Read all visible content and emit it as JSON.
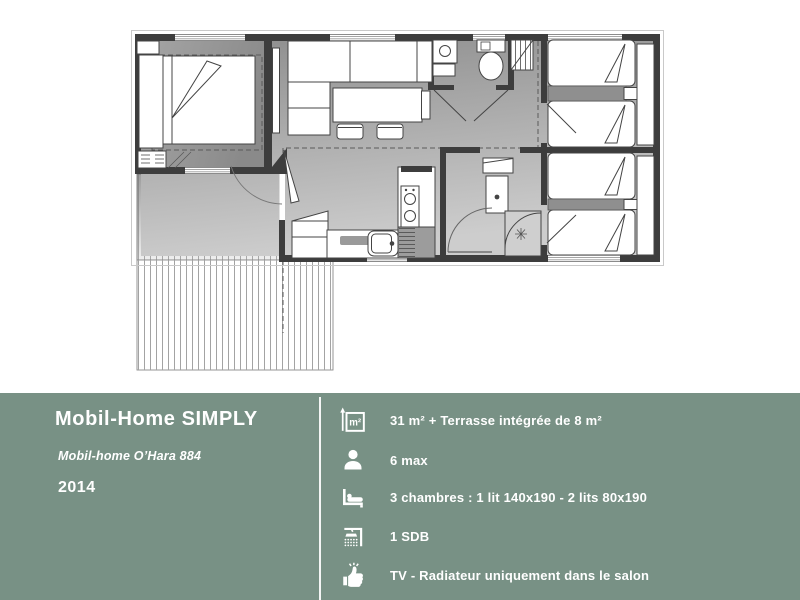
{
  "panel": {
    "background": "#789185",
    "text_color": "#ffffff",
    "title": "Mobil-Home SIMPLY",
    "subtitle": "Mobil-home O’Hara 884",
    "year": "2014",
    "features": [
      {
        "icon": "area-icon",
        "label": "31 m²  + Terrasse intégrée de 8 m²"
      },
      {
        "icon": "person-icon",
        "label": "6 max"
      },
      {
        "icon": "bed-icon",
        "label": "3 chambres : 1 lit 140x190 - 2 lits 80x190"
      },
      {
        "icon": "shower-icon",
        "label": "1 SDB"
      },
      {
        "icon": "thumb-up-icon",
        "label": "TV - Radiateur uniquement dans le salon"
      }
    ]
  },
  "floorplan": {
    "wall_color": "#3d3d3d",
    "floor_color_top": "#909090",
    "floor_color_bottom": "#c9c9c9",
    "rooms": [
      "master-bedroom",
      "living-dining",
      "kitchen",
      "wc",
      "bathroom",
      "twin-bedroom-1",
      "twin-bedroom-2",
      "integrated-terrace",
      "deck"
    ]
  }
}
